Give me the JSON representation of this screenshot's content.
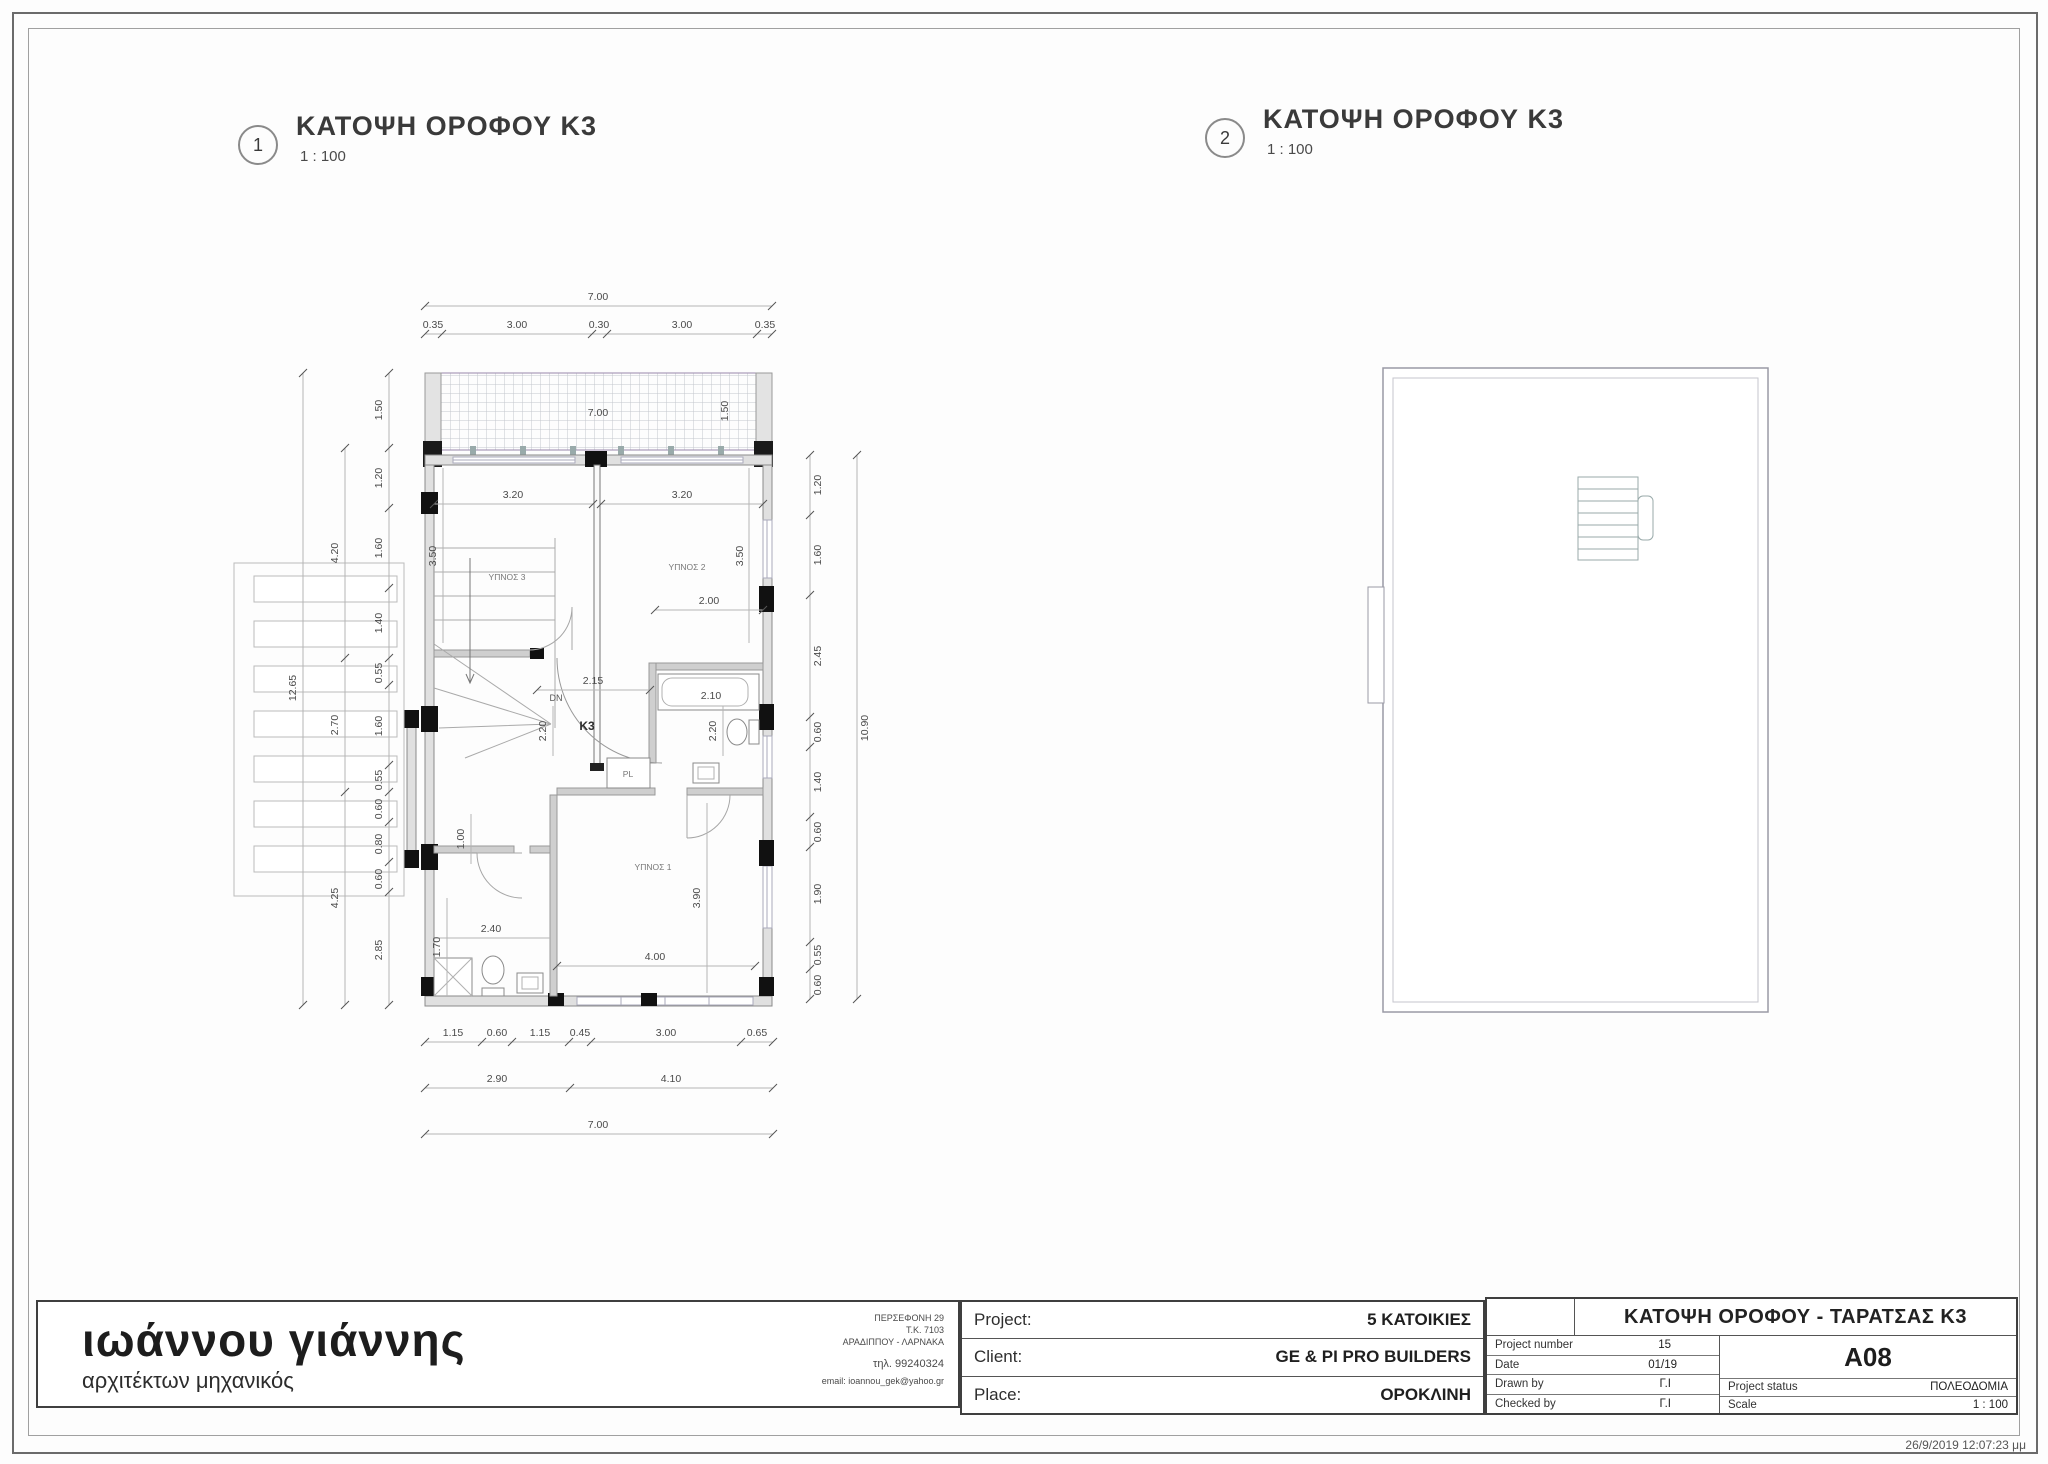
{
  "views": [
    {
      "number": "1",
      "title": "ΚΑΤΟΨΗ ΟΡΟΦΟΥ Κ3",
      "scale": "1 : 100"
    },
    {
      "number": "2",
      "title": "ΚΑΤΟΨΗ  ΟΡΟΦΟΥ Κ3",
      "scale": "1 : 100"
    }
  ],
  "plan1": {
    "rooms": {
      "bedroom1": "ΥΠΝΟΣ 1",
      "bedroom2": "ΥΠΝΟΣ 2",
      "bedroom3": "ΥΠΝΟΣ 3",
      "unit": "Κ3",
      "closet": "PL",
      "stair_down": "DN"
    },
    "dims": {
      "top_total": "7.00",
      "top_chain": [
        "0.35",
        "3.00",
        "0.30",
        "3.00",
        "0.35"
      ],
      "balcony_width": "7.00",
      "balcony_depth_right": "1.50",
      "left_chain": [
        "1.50",
        "1.20",
        "1.60",
        "1.40",
        "0.55",
        "1.60",
        "0.55",
        "0.60",
        "0.80",
        "0.60",
        "2.85"
      ],
      "left_mid": [
        "4.20",
        "2.70",
        "4.25"
      ],
      "left_total": "12.65",
      "right_chain": [
        "1.20",
        "1.60",
        "2.45",
        "0.60",
        "1.40",
        "0.60",
        "1.90",
        "0.55",
        "0.60"
      ],
      "right_total": "10.90",
      "bottom_chain": [
        "1.15",
        "0.60",
        "1.15",
        "0.45",
        "3.00",
        "0.65"
      ],
      "bottom_mid": [
        "2.90",
        "4.10"
      ],
      "bottom_total": "7.00",
      "interior": {
        "bed3_width": "3.20",
        "bed2_width": "3.20",
        "bed3_depth": "3.50",
        "bed2_depth": "3.50",
        "bath_top": "2.00",
        "hall_width": "2.15",
        "tub": "2.10",
        "hall_depth": "2.20",
        "wc_depth": "2.20",
        "wc_width": "1.00",
        "bath2_width": "2.40",
        "bath2_depth": "1.70",
        "bed1_width": "4.00",
        "bed1_depth": "3.90"
      }
    }
  },
  "titleblock": {
    "architect": {
      "name": "ιωάννου γιάννης",
      "profession": "αρχιτέκτων μηχανικός",
      "address_lines": [
        "ΠΕΡΣΕΦΟΝΗ 29",
        "Τ.Κ. 7103",
        "ΑΡΑΔΙΠΠΟΥ - ΛΑΡΝΑΚΑ"
      ],
      "phone": "τηλ. 99240324",
      "email": "email: ioannou_gek@yahoo.gr"
    },
    "project": {
      "label": "Project:",
      "value": "5 ΚΑΤΟΙΚΙΕΣ"
    },
    "client": {
      "label": "Client:",
      "value": "GE & PI PRO BUILDERS"
    },
    "place": {
      "label": "Place:",
      "value": "ΟΡΟΚΛΙΝΗ"
    },
    "sheet": {
      "title": "ΚΑΤΟΨΗ ΟΡΟΦΟΥ - ΤΑΡΑΤΣΑΣ Κ3",
      "project_number_label": "Project number",
      "project_number": "15",
      "date_label": "Date",
      "date": "01/19",
      "drawn_by_label": "Drawn by",
      "drawn_by": "Γ.Ι",
      "checked_by_label": "Checked by",
      "checked_by": "Γ.Ι",
      "sheet_number": "A08",
      "status_label": "Project status",
      "status": "ΠΟΛΕΟΔΟΜΙΑ",
      "scale_label": "Scale",
      "scale": "1 : 100"
    }
  },
  "footer": {
    "timestamp": "26/9/2019 12:07:23 μμ"
  }
}
